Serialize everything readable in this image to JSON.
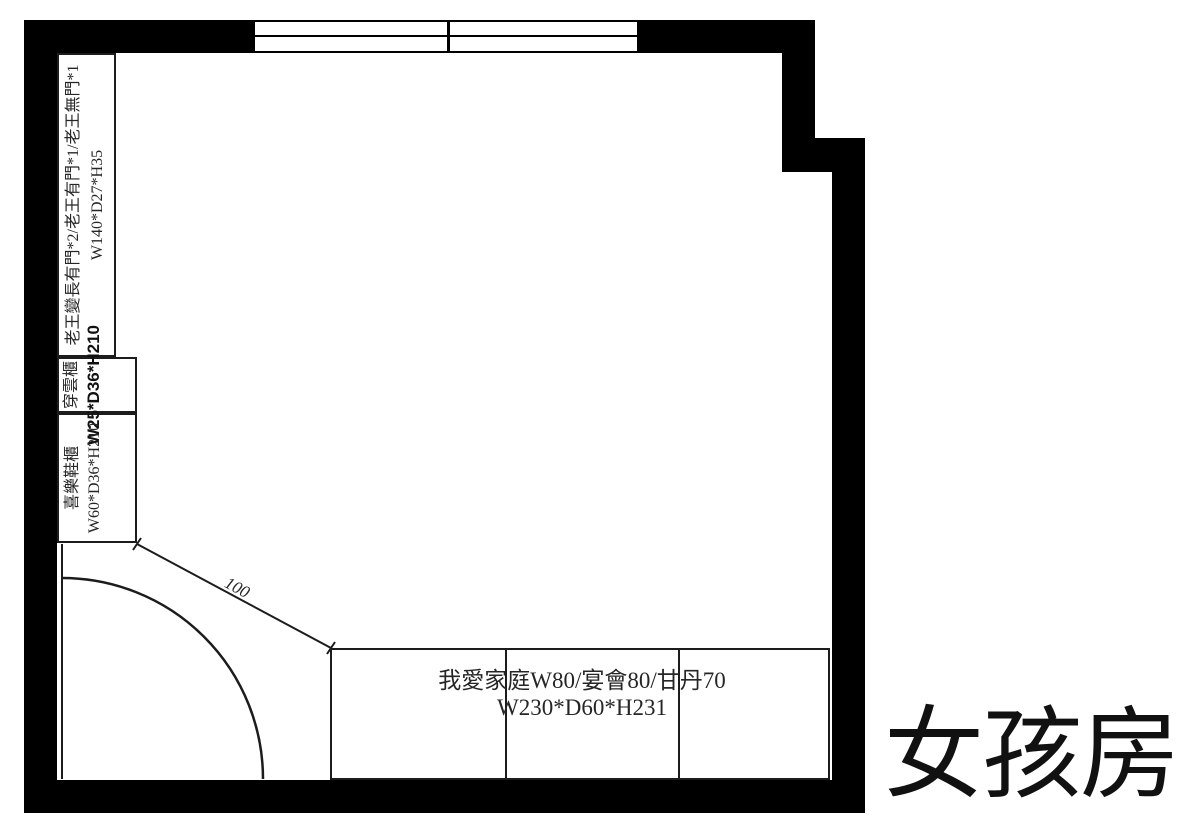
{
  "plan": {
    "room_label": "女孩房",
    "door_clearance_dim": "100"
  },
  "cabinets": {
    "long_cabinet": {
      "spec": "老王變長有門*2/老王有門*1/老王無門*1",
      "size": "W140*D27*H35"
    },
    "chuanyun_cabinet": {
      "name": "穿雲櫃",
      "size": "W25*D36*H210"
    },
    "shoe_cabinet": {
      "name": "喜樂鞋櫃",
      "size": "W60*D36*H210"
    },
    "wardrobe": {
      "spec": "我愛家庭W80/宴會80/甘丹70",
      "size": "W230*D60*H231"
    }
  },
  "colors": {
    "wall": "#000000",
    "line": "#1c1c1c",
    "background": "#ffffff",
    "text": "#262626"
  }
}
